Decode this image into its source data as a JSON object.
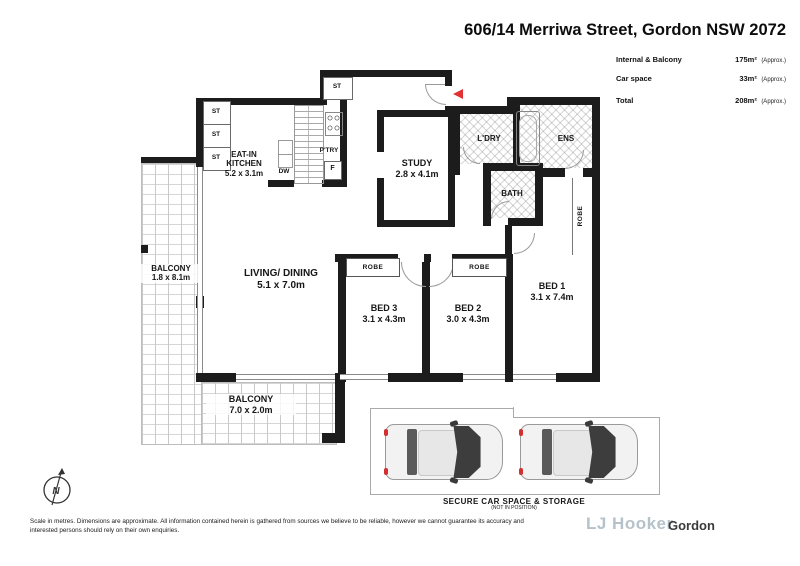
{
  "header": {
    "title": "606/14 Merriwa Street, Gordon NSW 2072",
    "areas": [
      {
        "label": "Internal & Balcony",
        "value": "175m²",
        "note": "(Approx.)"
      },
      {
        "label": "Car space",
        "value": "33m²",
        "note": "(Approx.)"
      },
      {
        "label": "Total",
        "value": "208m²",
        "note": "(Approx.)"
      }
    ]
  },
  "plan": {
    "rooms": {
      "kitchen": {
        "line1": "EAT-IN",
        "line2": "KITCHEN",
        "dims": "5.2 x 3.1m"
      },
      "study": {
        "name": "STUDY",
        "dims": "2.8 x 4.1m"
      },
      "living": {
        "name": "LIVING/ DINING",
        "dims": "5.1 x 7.0m"
      },
      "bed1": {
        "name": "BED 1",
        "dims": "3.1 x 7.4m"
      },
      "bed2": {
        "name": "BED 2",
        "dims": "3.0 x 4.3m"
      },
      "bed3": {
        "name": "BED 3",
        "dims": "3.1 x 4.3m"
      },
      "laundry": {
        "name": "L'DRY"
      },
      "ensuite": {
        "name": "ENS"
      },
      "bath": {
        "name": "BATH"
      },
      "balcony_left": {
        "name": "BALCONY",
        "dims": "1.8 x 8.1m"
      },
      "balcony_bottom": {
        "name": "BALCONY",
        "dims": "7.0 x 2.0m"
      }
    },
    "fixtures": {
      "robe": "ROBE",
      "st": "ST",
      "pantry": "P'TRY",
      "dishwasher": "DW",
      "fridge": "F"
    },
    "compass_n": "N"
  },
  "carspace": {
    "title": "SECURE CAR SPACE & STORAGE",
    "subtitle": "(NOT IN POSITION)"
  },
  "footer": {
    "disclaimer_line1": "Scale in metres. Dimensions are approximate. All information contained herein is gathered from sources we believe to be reliable, however we cannot guarantee its accuracy and",
    "disclaimer_line2": "interested persons should rely on their own enquiries.",
    "brand": "LJ Hooker",
    "office": "Gordon"
  }
}
